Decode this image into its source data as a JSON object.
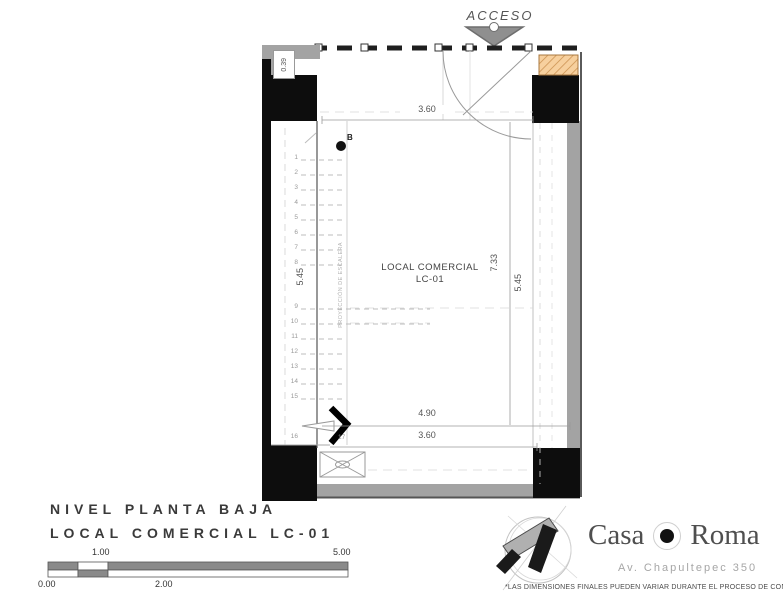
{
  "plan": {
    "access_label": "ACCESO",
    "room_name": "LOCAL COMERCIAL",
    "room_code": "LC-01",
    "stair_note": "PROYECCIÓN DE ESCALERA",
    "point_label": "B",
    "dims": {
      "wall_offset": "0.39",
      "top_width": "3.60",
      "left_height": "5.45",
      "interior_height": "7.33",
      "right_height": "5.45",
      "bottom_outer": "4.90",
      "bottom_inner": "3.60"
    },
    "stairs": [
      "1",
      "2",
      "3",
      "4",
      "5",
      "6",
      "7",
      "8",
      "9",
      "10",
      "11",
      "12",
      "13",
      "14",
      "15",
      "16",
      "17"
    ]
  },
  "titleblock": {
    "line1": "NIVEL PLANTA BAJA",
    "line2": "LOCAL COMERCIAL LC-01"
  },
  "scalebar": {
    "l0": "0.00",
    "l1": "1.00",
    "l2": "2.00",
    "l5": "5.00"
  },
  "brand": {
    "word1": "Casa",
    "word2": "Roma",
    "address": "Av. Chapultepec 350",
    "disclaimer": "*LAS DIMENSIONES FINALES PUEDEN VARIAR DURANTE EL PROCESO DE CONSTRUCCIÓN."
  },
  "colors": {
    "wall_black": "#0d0d0d",
    "wall_gray": "#a3a3a3",
    "hatch_orange": "#f7d09e",
    "line_gray": "#8a8a8a"
  }
}
